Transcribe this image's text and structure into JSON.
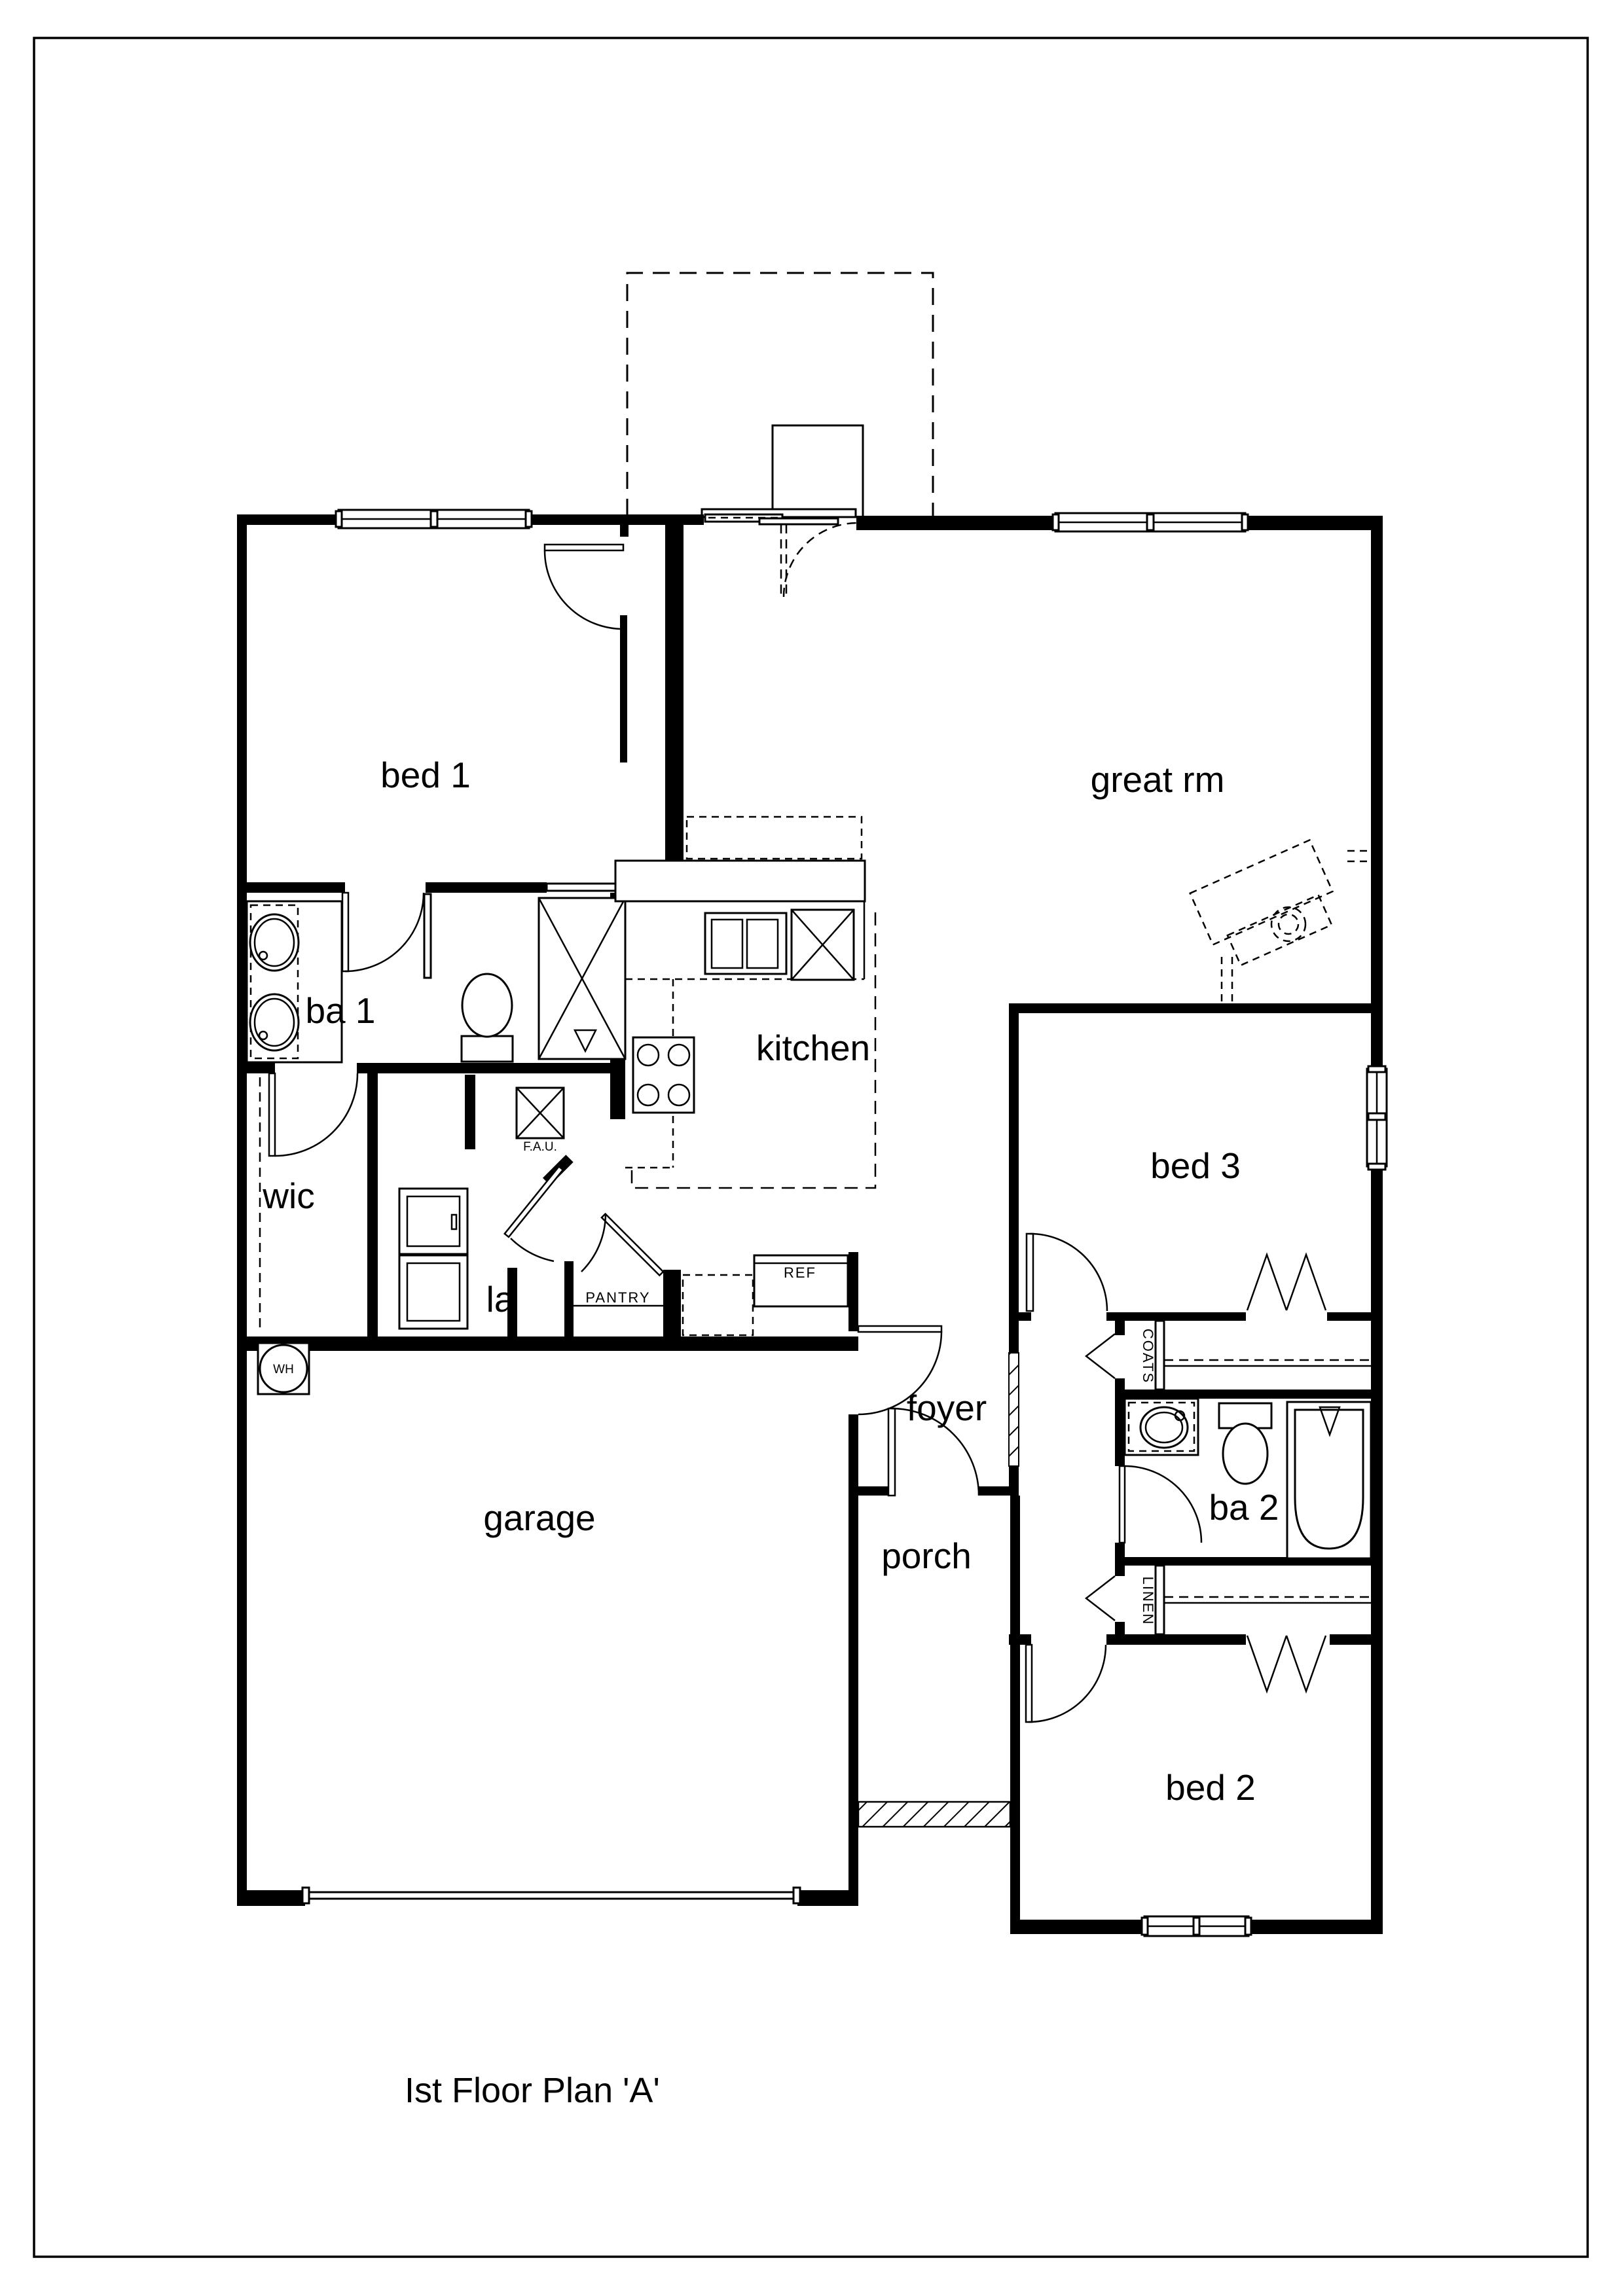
{
  "title": "Ist Floor Plan 'A'",
  "rooms": {
    "bed1": "bed 1",
    "great_rm": "great rm",
    "ba1": "ba 1",
    "kitchen": "kitchen",
    "wic": "wic",
    "la": "la",
    "bed3": "bed 3",
    "foyer": "foyer",
    "garage": "garage",
    "ba2": "ba 2",
    "porch": "porch",
    "bed2": "bed 2"
  },
  "closets": {
    "pantry": "PANTRY",
    "coats": "COATS",
    "linen": "LINEN"
  },
  "appliances": {
    "ref": "REF",
    "wh": "WH",
    "fau": "F.A.U."
  }
}
